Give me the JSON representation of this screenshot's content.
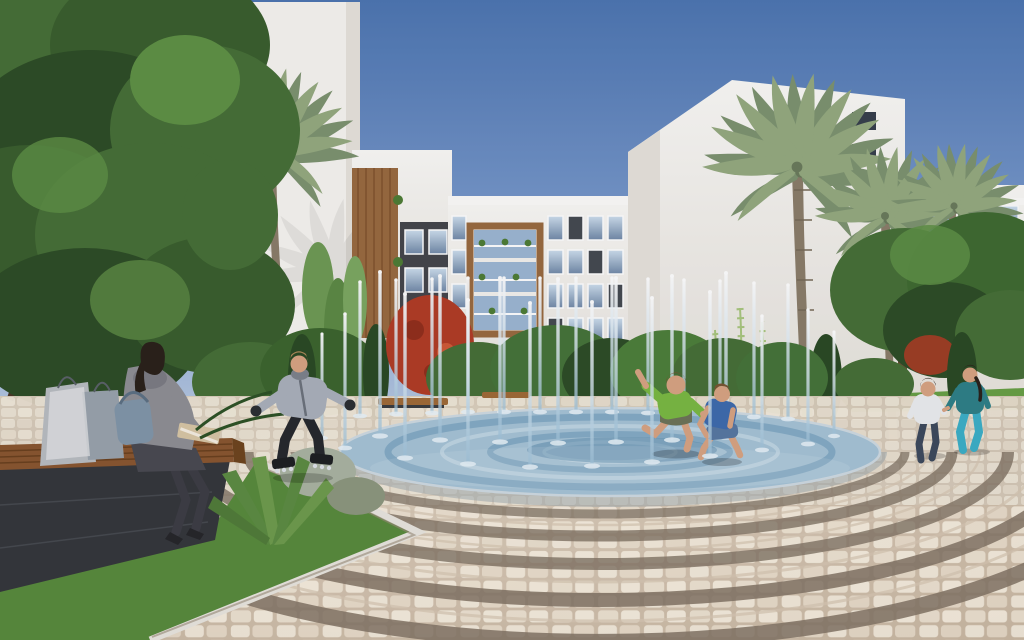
{
  "meta": {
    "kind": "architectural-rendering",
    "description": "Sunny courtyard plaza of a modern white apartment complex: an interactive splash-pad fountain with vertical water jets, children playing in the water, a boy rollerblading, a woman reading on a wooden bench with shopping bags, a mother and child strolling, palm trees, hedges and a circular cobblestone mosaic plaza."
  },
  "scene": {
    "sky": {
      "condition": "clear"
    },
    "buildings": [
      {
        "id": "left-tower",
        "style": "white blank side wall, palm in front"
      },
      {
        "id": "left-wing",
        "style": "white with wood-slat feature and dark panel"
      },
      {
        "id": "center-block",
        "style": "5 floors, wood-framed balcony bay with plants"
      },
      {
        "id": "corner-slab",
        "style": "tall white blank wall with climbing vines"
      },
      {
        "id": "right-wing",
        "style": "white floor slabs, glass balconies"
      }
    ],
    "fountain": {
      "type": "splash-pad",
      "jet_count": 31,
      "shape": "circular blue mosaic, flush with plaza"
    },
    "people": [
      {
        "id": "woman-reading",
        "pose": "seated on wooden bench, reading",
        "top": "grey knit sweater and scarf",
        "legs": "dark tights, heels",
        "props": "handbag, two shopping bags, open book"
      },
      {
        "id": "boy-rollerblading",
        "pose": "skating forward, arms back",
        "top": "grey jacket",
        "bottom": "black pants, inline skates, dark gloves"
      },
      {
        "id": "boy-green-shirt",
        "pose": "jumping through fountain jets",
        "top": "green t-shirt",
        "bottom": "camo shorts, barefoot"
      },
      {
        "id": "boy-blue-shirt",
        "pose": "crouch-running in fountain",
        "top": "blue t-shirt",
        "bottom": "jean shorts, barefoot"
      },
      {
        "id": "child-white-shirt",
        "pose": "walking away holding hands",
        "top": "white long-sleeve",
        "bottom": "dark jeans"
      },
      {
        "id": "woman-teal",
        "pose": "walking away holding child's hand",
        "top": "teal top",
        "bottom": "turquoise pants",
        "hair": "dark braid"
      }
    ],
    "vegetation": [
      "large leafy tree top-left",
      "4 fan palms",
      "hedge band with cypress columns",
      "red flowering bush",
      "climbing vines on white walls",
      "agave and silver shrubs in planting bed",
      "lawn strips"
    ],
    "plaza": {
      "paving": "cream cobblestone mosaic with dark concentric arc bands",
      "furniture": "wooden benches on dark stone bases"
    }
  },
  "palette": {
    "sky_top": "#4d76b2",
    "sky_mid": "#7e9dcf",
    "sky_horizon": "#b9cbe3",
    "building_white": "#f7f5f1",
    "building_shade": "#e7e3dc",
    "accent_dark": "#45464c",
    "wood": "#9a6a40",
    "wood_dark": "#7c4e2a",
    "glass_light": "#c7d9ea",
    "glass_dark": "#71889f",
    "palm_green": "#95aa80",
    "palm_shadow": "#7d9370",
    "palm_trunk": "#8b7d6a",
    "tree_dark": "#2e4d27",
    "tree_mid": "#477038",
    "tree_light": "#5f9146",
    "grass": "#68a046",
    "cypress": "#2b4a25",
    "flower_red": "#b23c26",
    "vine_green": "#a9c77f",
    "paving_grout": "#c9b7a2",
    "paving_band": "#827465",
    "pool_base": "#a6c4d7",
    "pool_ring": "#6f9cba",
    "pool_deep": "#4f82a6",
    "bench_wood": "#8a5731",
    "stone_dark": "#35373c",
    "curb": "#e9e6df",
    "skin": "#d9a483",
    "sweater_grey": "#8f8f95",
    "tights_dark": "#3d3d45",
    "bag_grey": "#b9bdc2",
    "handbag_blue": "#8297aa",
    "jacket_grey": "#aab1bc",
    "pants_black": "#26282d",
    "shirt_green": "#7ab943",
    "shorts_camo": "#6e7459",
    "shirt_blue": "#3e6cae",
    "shorts_jean": "#5878a2",
    "shirt_white": "#eceef0",
    "jeans_dark": "#3d4a5e",
    "teal_top": "#2f8188",
    "teal_pants": "#3cb0c8",
    "hair_dark": "#2b211b",
    "hair_brown": "#7a5433"
  }
}
